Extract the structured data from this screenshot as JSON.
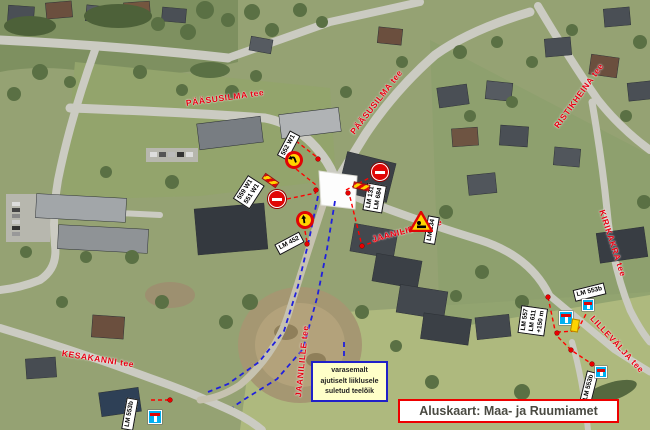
{
  "map": {
    "base_caption": "Aluskaart: Maa- ja Ruumiamet",
    "note_box": {
      "lines": [
        "varasemalt",
        "ajutiselt liiklusele",
        "suletud teelõik"
      ]
    },
    "street_labels": [
      {
        "name": "PÄÄSUSILMA tee"
      },
      {
        "name": "PÄÄSUSILMA tee"
      },
      {
        "name": "RISTIKHEINA tee"
      },
      {
        "name": "KIRIKAKRA tee"
      },
      {
        "name": "JAANILILLE tee"
      },
      {
        "name": "JAANILILLE tee"
      },
      {
        "name": "KESAKANNI tee"
      },
      {
        "name": "LILLEVÄLJA tee"
      }
    ],
    "sign_labels": [
      {
        "lines": [
          "552 W1"
        ]
      },
      {
        "lines": [
          "559 W1",
          "551 W1"
        ]
      },
      {
        "lines": [
          "LM 131",
          "LM 684"
        ]
      },
      {
        "lines": [
          "LM 134"
        ]
      },
      {
        "lines": [
          "LM 452"
        ]
      },
      {
        "lines": [
          "LM 557",
          "LM 611",
          "+150 m"
        ]
      },
      {
        "lines": [
          "LM 553b"
        ]
      },
      {
        "lines": [
          "LM 553b"
        ]
      },
      {
        "lines": [
          "LM 553b"
        ]
      }
    ],
    "icons": {
      "no_entry_sign": "red-circle-white-bar",
      "left_curve_sign": "yellow-circle-left-curve-arrow",
      "ahead_sign": "yellow-circle-up-arrow",
      "roadworks_sign": "red-triangle-warning",
      "dead_end_sign": "blue-square-dead-end",
      "barrier_marker": "red-yellow-stripes"
    },
    "colors": {
      "street_label_red": "#e60012",
      "dashed_red": "#ff0000",
      "dashed_blue": "#2020dd",
      "note_bg": "#ffffc8",
      "note_border": "#2020c8",
      "caption_border": "#ee0000",
      "dead_end_blue": "#00b0f0",
      "sign_yellow": "#ffd400",
      "no_entry_red": "#e00505"
    }
  }
}
